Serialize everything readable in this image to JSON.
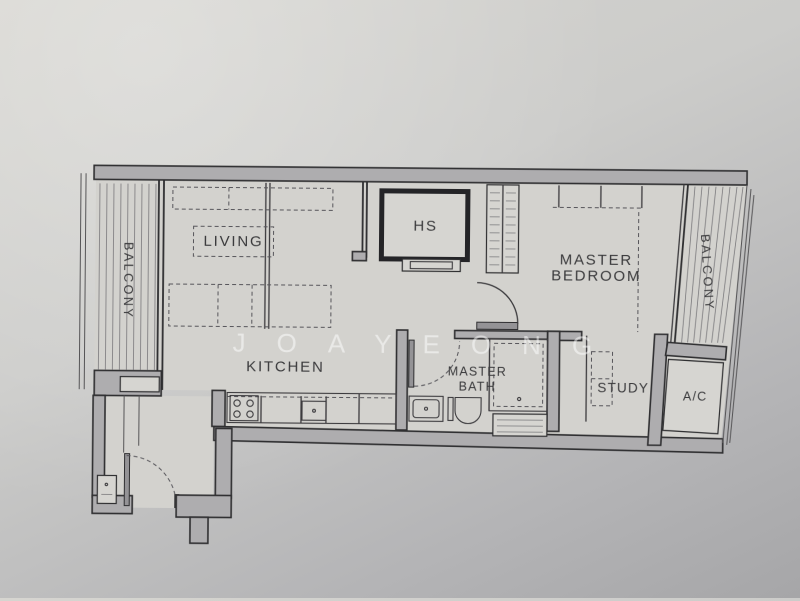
{
  "meta": {
    "subject": "apartment floor plan photograph"
  },
  "colors": {
    "paper_light": "#d6d5d0",
    "paper_dark": "#a6a6a8",
    "wall_fill": "#aeadaf",
    "line": "#2f2f31",
    "label": "#3a3a3c",
    "watermark": "rgba(255,255,255,0.5)"
  },
  "rooms": {
    "balcony_left": "BALCONY",
    "living": "LIVING",
    "hs": "HS",
    "master_bedroom_line1": "MASTER",
    "master_bedroom_line2": "BEDROOM",
    "balcony_right": "BALCONY",
    "kitchen": "KITCHEN",
    "master_bath_line1": "MASTER",
    "master_bath_line2": "BATH",
    "study": "STUDY",
    "ac": "A/C"
  },
  "watermark": "JOAYEONG"
}
